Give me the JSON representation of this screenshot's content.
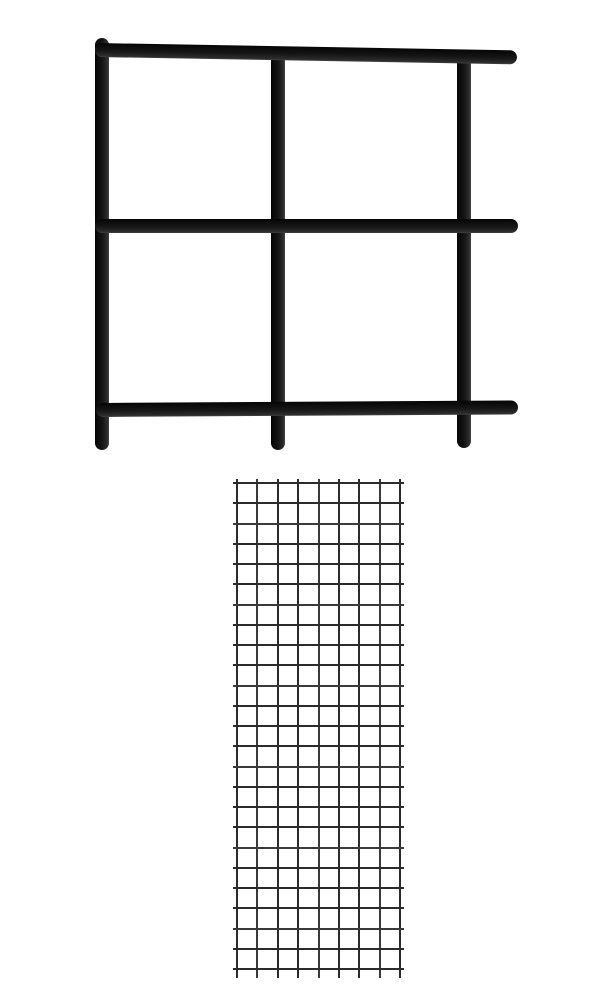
{
  "page": {
    "description": "Product image of black gridwall panels: a close-up welded square-tube grid frame on top and a full 8x24 square wire mesh grid panel below",
    "background_color": "#ffffff",
    "width": 600,
    "height": 1000
  },
  "tube_frame": {
    "label": "tube-grid-frame-closeup",
    "color": "#141414",
    "tube_thickness": 14,
    "corner_radius": 7,
    "vertical_bars": [
      {
        "id": "left-upright",
        "x": 95,
        "y": 38,
        "height": 412
      },
      {
        "id": "middle-upright",
        "x": 271,
        "y": 50,
        "height": 400
      },
      {
        "id": "right-upright",
        "x": 457,
        "y": 54,
        "height": 394
      }
    ],
    "horizontal_bars": [
      {
        "id": "top-rail",
        "x": 95,
        "y": 43,
        "width": 422,
        "angle_deg": 1.0
      },
      {
        "id": "middle-rail",
        "x": 95,
        "y": 219,
        "width": 423,
        "angle_deg": 0
      },
      {
        "id": "bottom-rail",
        "x": 96,
        "y": 403,
        "width": 422,
        "angle_deg": -0.35
      }
    ]
  },
  "mesh_panel": {
    "label": "wire-mesh-grid-panel",
    "wire_color": "#2b2b2b",
    "wire_color_alt": "#3a3a3a",
    "wire_thickness": 2,
    "x": 236,
    "y": 482,
    "width": 165,
    "height": 488,
    "columns": 8,
    "rows": 24,
    "vertical_wires": 9,
    "horizontal_wires": 25,
    "overhang": {
      "top": 3,
      "bottom": 8,
      "left": 3,
      "right": 3
    }
  }
}
